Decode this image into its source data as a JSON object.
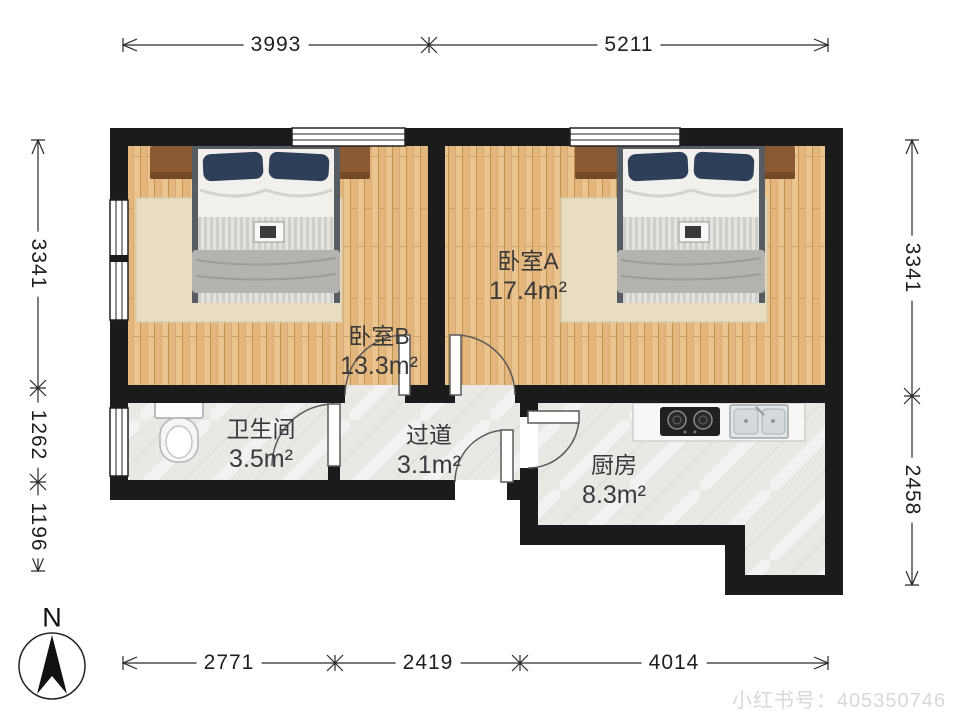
{
  "rooms": [
    {
      "name": "卧室A",
      "area": "17.4m²"
    },
    {
      "name": "卧室B",
      "area": "13.3m²"
    },
    {
      "name": "卫生间",
      "area": "3.5m²"
    },
    {
      "name": "过道",
      "area": "3.1m²"
    },
    {
      "name": "厨房",
      "area": "8.3m²"
    }
  ],
  "dimensions": {
    "top": [
      "3993",
      "5211"
    ],
    "bottom": [
      "2771",
      "2419",
      "4014"
    ],
    "left": [
      "3341",
      "1262",
      "1196"
    ],
    "right": [
      "3341",
      "2458"
    ]
  },
  "compass": {
    "label": "N"
  },
  "watermark": {
    "text": "小红书号：405350746"
  },
  "colors": {
    "wall": "#1b1b1b",
    "wood_floor": "#eac38e",
    "tile_floor": "#e9e8e5",
    "pillow": "#2e4059",
    "headboard": "#8a5a34"
  }
}
